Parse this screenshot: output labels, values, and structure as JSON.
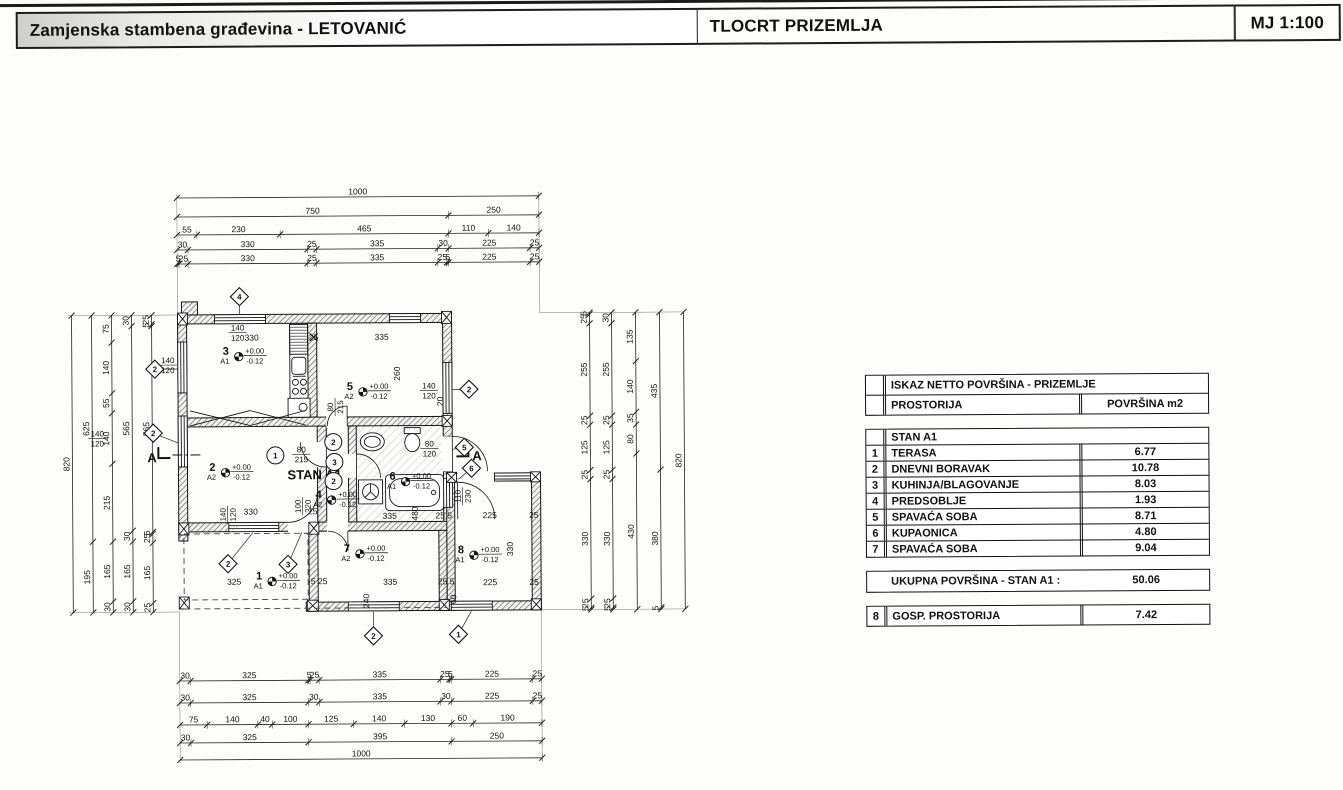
{
  "header": {
    "project_title": "Zamjenska stambena građevina - LETOVANIĆ",
    "drawing_title": "TLOCRT PRIZEMLJA",
    "scale_label": "MJ 1:100"
  },
  "table": {
    "title": "ISKAZ NETTO POVRŠINA - PRIZEMLJE",
    "col_room": "PROSTORIJA",
    "col_area": "POVRŠINA m2",
    "group_label": "STAN A1",
    "rooms": [
      {
        "num": "1",
        "name": "TERASA",
        "area": "6.77"
      },
      {
        "num": "2",
        "name": "DNEVNI BORAVAK",
        "area": "10.78"
      },
      {
        "num": "3",
        "name": "KUHINJA/BLAGOVANJE",
        "area": "8.03"
      },
      {
        "num": "4",
        "name": "PREDSOBLJE",
        "area": "1.93"
      },
      {
        "num": "5",
        "name": "SPAVAĆA SOBA",
        "area": "8.71"
      },
      {
        "num": "6",
        "name": "KUPAONICA",
        "area": "4.80"
      },
      {
        "num": "7",
        "name": "SPAVAĆA SOBA",
        "area": "9.04"
      }
    ],
    "total_label": "UKUPNA POVRŠINA - STAN A1 :",
    "total_value": "50.06",
    "extra_row": {
      "num": "8",
      "name": "GOSP. PROSTORIJA",
      "area": "7.42"
    }
  },
  "plan": {
    "apartment_label": "STAN A1",
    "section_label": "A",
    "elev_plus": "+0.00",
    "elev_minus": "-0.12",
    "dims": {
      "top": [
        [
          "1000"
        ],
        [
          "750",
          "250"
        ],
        [
          "55",
          "230",
          "465",
          "110",
          "140"
        ],
        [
          "30",
          "330",
          "25",
          "335",
          "30",
          "225",
          "25"
        ],
        [
          "5",
          "25",
          "330",
          "25",
          "335",
          "25",
          "5",
          "225",
          "25"
        ]
      ],
      "bottom": [
        [
          "30",
          "325",
          "5",
          "25",
          "335",
          "25",
          "5",
          "225",
          "25"
        ],
        [
          "30",
          "325",
          "30",
          "335",
          "30",
          "225",
          "25"
        ],
        [
          "75",
          "140",
          "40",
          "100",
          "125",
          "140",
          "130",
          "60",
          "190"
        ],
        [
          "30",
          "325",
          "395",
          "250"
        ],
        [
          "1000"
        ]
      ],
      "left": [
        [
          "820"
        ],
        [
          "625",
          "195"
        ],
        [
          "75",
          "140",
          "55",
          "140",
          "215",
          "165",
          "30"
        ],
        [
          "30",
          "565",
          "30",
          "165",
          "30"
        ],
        [
          "25",
          "5",
          "565",
          "5",
          "25",
          "165",
          "25"
        ]
      ],
      "right": [
        [
          "820"
        ],
        [
          "435",
          "380",
          "5"
        ],
        [
          "135",
          "140",
          "35",
          "80",
          "430"
        ],
        [
          "30",
          "255",
          "25",
          "125",
          "25",
          "330",
          "25",
          "5"
        ],
        [
          "5",
          "25",
          "255",
          "25",
          "125",
          "25",
          "330",
          "25",
          "5"
        ]
      ]
    },
    "rooms": [
      {
        "num": "1",
        "code": "A1",
        "x": 258,
        "y": 577
      },
      {
        "num": "2",
        "code": "A2",
        "x": 212,
        "y": 468
      },
      {
        "num": "3",
        "code": "A1",
        "x": 226,
        "y": 352
      },
      {
        "num": "4",
        "code": "A2",
        "x": 318,
        "y": 496
      },
      {
        "num": "5",
        "code": "A2",
        "x": 350,
        "y": 388
      },
      {
        "num": "6",
        "code": "A1",
        "x": 392,
        "y": 478
      },
      {
        "num": "7",
        "code": "A2",
        "x": 346,
        "y": 550
      },
      {
        "num": "8",
        "code": "A1",
        "x": 460,
        "y": 552
      }
    ],
    "window_markers": [
      {
        "n": "4",
        "x": 240,
        "y": 294,
        "lx": 240,
        "ly": 312
      },
      {
        "n": "2",
        "x": 155,
        "y": 366,
        "lx": 178,
        "ly": 366
      },
      {
        "n": "2",
        "x": 153,
        "y": 430,
        "lx": 178,
        "ly": 440
      },
      {
        "n": "2",
        "x": 469,
        "y": 388,
        "lx": 452,
        "ly": 388
      },
      {
        "n": "5",
        "x": 464,
        "y": 446,
        "lx": 452,
        "ly": 448
      },
      {
        "n": "6",
        "x": 471,
        "y": 467,
        "lx": 458,
        "ly": 478
      },
      {
        "n": "2",
        "x": 227,
        "y": 561,
        "lx": 252,
        "ly": 530
      },
      {
        "n": "3",
        "x": 287,
        "y": 562,
        "lx": 301,
        "ly": 530
      },
      {
        "n": "2",
        "x": 372,
        "y": 634,
        "lx": 372,
        "ly": 610
      },
      {
        "n": "1",
        "x": 457,
        "y": 633,
        "lx": 470,
        "ly": 610
      }
    ],
    "door_markers": [
      {
        "n": "1",
        "x": 275,
        "y": 453
      },
      {
        "n": "2",
        "x": 333,
        "y": 440
      },
      {
        "n": "3",
        "x": 334,
        "y": 460
      },
      {
        "n": "2",
        "x": 333,
        "y": 479
      }
    ],
    "annotations": [
      {
        "t": "140/120",
        "x": 238,
        "y": 330,
        "frac": true
      },
      {
        "t": "330",
        "x": 252,
        "y": 338
      },
      {
        "t": "25",
        "x": 314,
        "y": 338
      },
      {
        "t": "335",
        "x": 382,
        "y": 338
      },
      {
        "t": "140/120",
        "x": 168,
        "y": 362,
        "frac": true
      },
      {
        "t": "140/120",
        "x": 97,
        "y": 435,
        "frac": true
      },
      {
        "t": "260",
        "x": 400,
        "y": 372,
        "rot": true
      },
      {
        "t": "140/120",
        "x": 429,
        "y": 389,
        "frac": true
      },
      {
        "t": "80/120",
        "x": 429,
        "y": 447,
        "frac": true
      },
      {
        "t": "20",
        "x": 443,
        "y": 400,
        "rot": true
      },
      {
        "t": "80/215",
        "x": 301,
        "y": 452,
        "frac": true
      },
      {
        "t": "80/215",
        "x": 335,
        "y": 405,
        "frac": true,
        "rot": true
      },
      {
        "t": "110/230",
        "x": 462,
        "y": 495,
        "frac": true,
        "rot": true
      },
      {
        "t": "100/220",
        "x": 302,
        "y": 504,
        "frac": true,
        "rot": true
      },
      {
        "t": "140/120",
        "x": 227,
        "y": 512,
        "frac": true,
        "rot": true
      },
      {
        "t": "330",
        "x": 250,
        "y": 512
      },
      {
        "t": "25",
        "x": 312,
        "y": 512
      },
      {
        "t": "335",
        "x": 389,
        "y": 517
      },
      {
        "t": "480",
        "x": 417,
        "y": 512,
        "rot": true
      },
      {
        "t": "25 5",
        "x": 443,
        "y": 517
      },
      {
        "t": "225",
        "x": 489,
        "y": 517
      },
      {
        "t": "25",
        "x": 533,
        "y": 517
      },
      {
        "t": "330",
        "x": 512,
        "y": 548,
        "rot": true
      },
      {
        "t": "325",
        "x": 233,
        "y": 582
      },
      {
        "t": "5 25",
        "x": 318,
        "y": 582
      },
      {
        "t": "335",
        "x": 389,
        "y": 583
      },
      {
        "t": "25 5",
        "x": 445,
        "y": 583
      },
      {
        "t": "225",
        "x": 489,
        "y": 584
      },
      {
        "t": "25",
        "x": 533,
        "y": 584
      },
      {
        "t": "240",
        "x": 368,
        "y": 599,
        "rot": true
      },
      {
        "t": "60",
        "x": 455,
        "y": 598,
        "rot": true
      }
    ]
  }
}
